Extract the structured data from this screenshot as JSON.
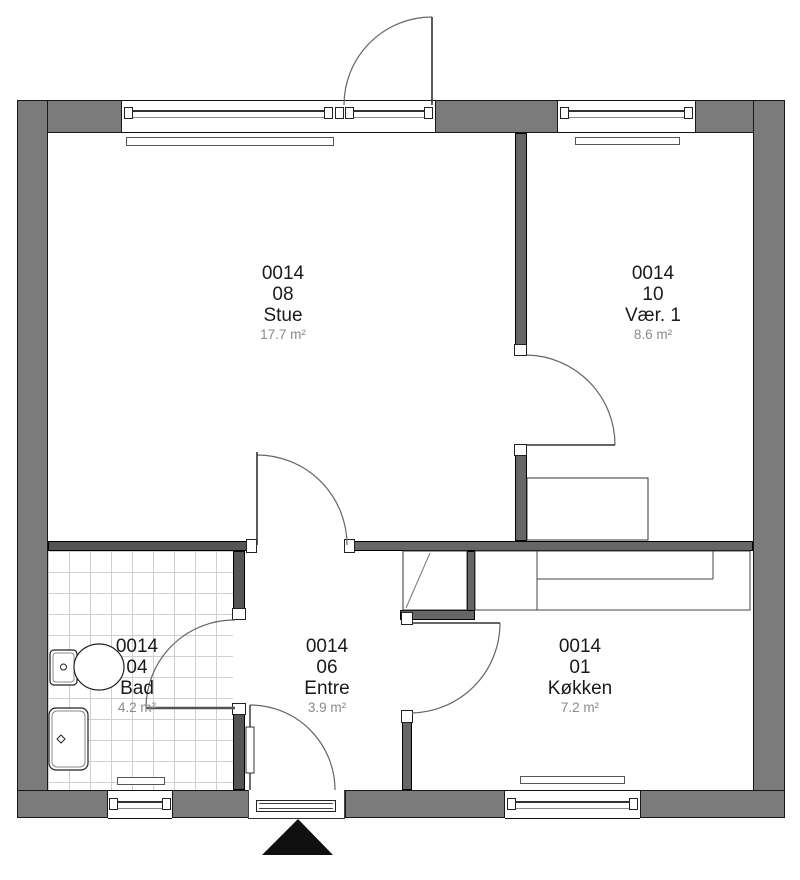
{
  "rooms": [
    {
      "unit": "0014",
      "number": "08",
      "name": "Stue",
      "area": "17.7 m²"
    },
    {
      "unit": "0014",
      "number": "10",
      "name": "Vær. 1",
      "area": "8.6 m²"
    },
    {
      "unit": "0014",
      "number": "04",
      "name": "Bad",
      "area": "4.2 m²"
    },
    {
      "unit": "0014",
      "number": "06",
      "name": "Entre",
      "area": "3.9 m²"
    },
    {
      "unit": "0014",
      "number": "01",
      "name": "Køkken",
      "area": "7.2 m²"
    }
  ],
  "colors": {
    "exterior_wall": "#7b7b7b",
    "interior_wall": "#666666",
    "outline": "#181818",
    "area_text": "#8a8a8a",
    "tile_line": "#cfcfcf",
    "entrance_marker": "#101010"
  }
}
